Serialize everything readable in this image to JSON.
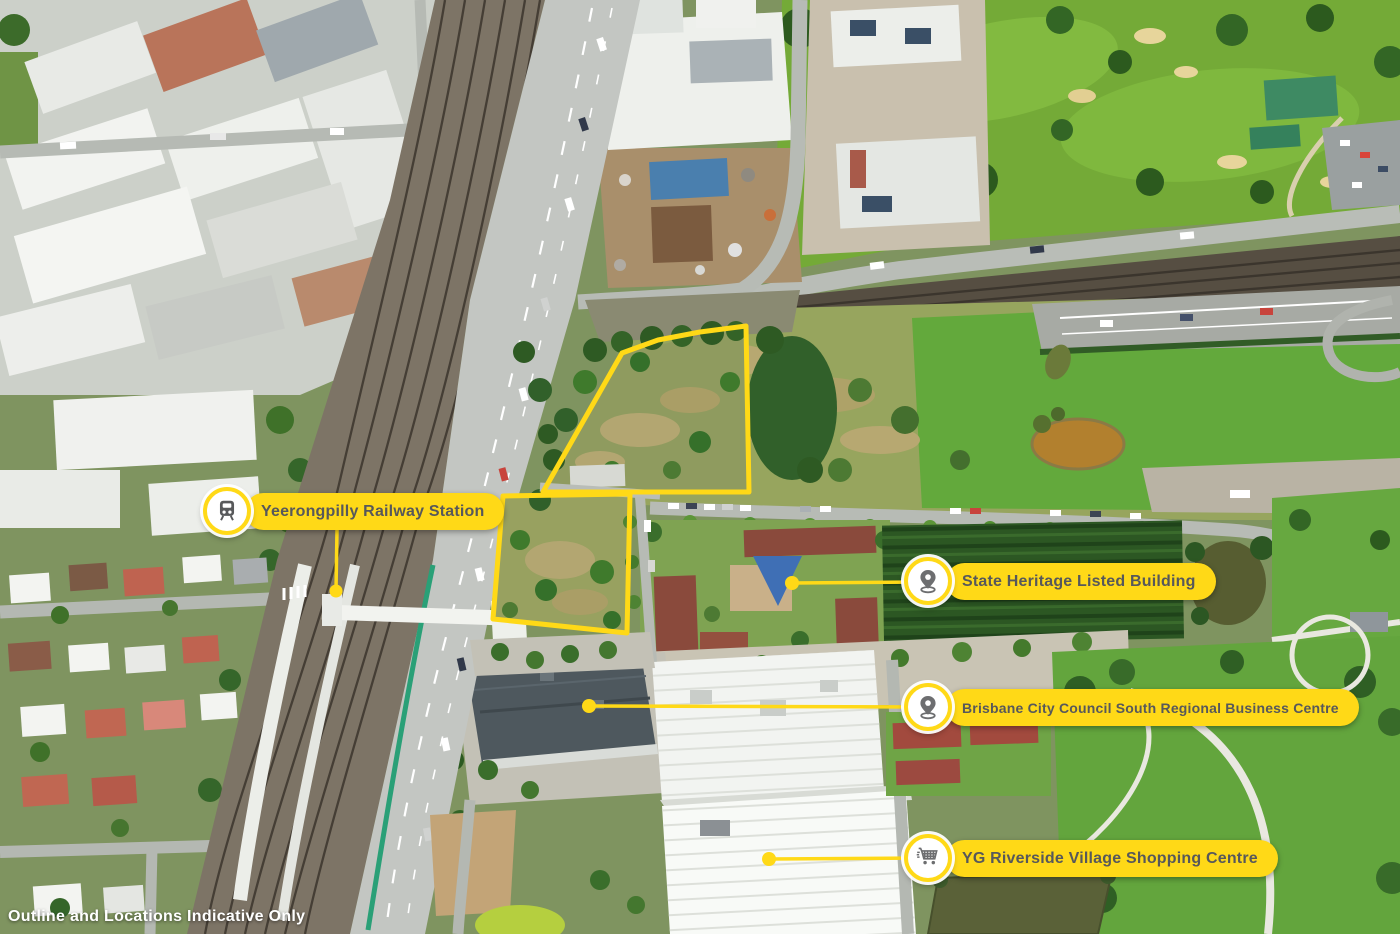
{
  "map": {
    "type": "annotated-aerial-photograph",
    "disclaimer": "Outline and Locations Indicative Only"
  },
  "annotations": {
    "station": {
      "label": "Yeerongpilly Railway Station",
      "icon": "train-icon"
    },
    "heritage": {
      "label": "State Heritage Listed Building",
      "icon": "map-pin-icon"
    },
    "council": {
      "label": "Brisbane City Council South Regional Business Centre",
      "icon": "map-pin-icon"
    },
    "shopping": {
      "label": "YG Riverside Village Shopping Centre",
      "icon": "shopping-cart-icon"
    }
  },
  "colors": {
    "accent_yellow": "#FFD917",
    "label_text": "#57585B",
    "icon_gray": "#6D6E70",
    "outline_yellow": "#FFD917"
  }
}
